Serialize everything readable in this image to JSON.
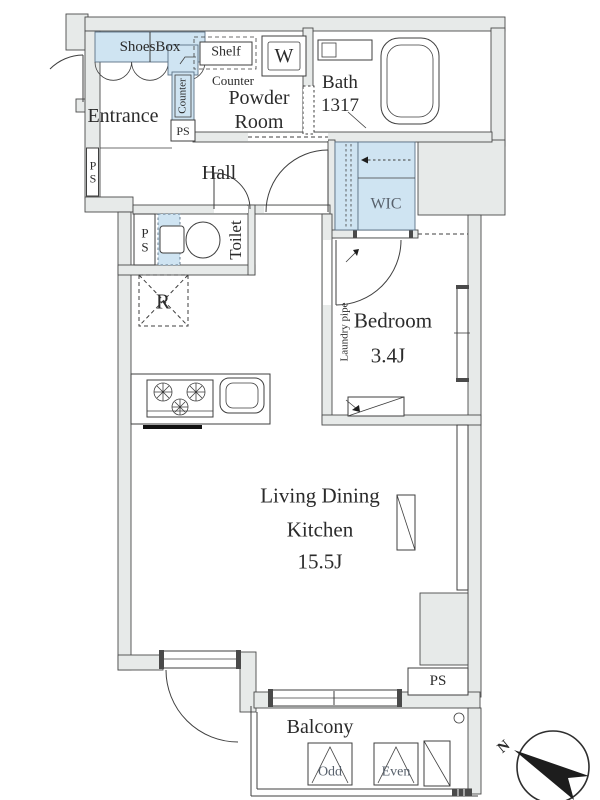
{
  "floorplan": {
    "rooms": {
      "entrance": "Entrance",
      "powder_room": "Powder Room",
      "bath": "Bath 1317",
      "hall": "Hall",
      "toilet": "Toilet",
      "wic": "WIC",
      "bedroom": "Bedroom",
      "bedroom_size": "3.4J",
      "ldk": "Living Dining Kitchen",
      "ldk_size": "15.5J",
      "balcony": "Balcony"
    },
    "fixtures": {
      "shoes_box": "ShoesBox",
      "shelf": "Shelf",
      "counter_vertical": "Counter",
      "counter_horizontal": "Counter",
      "washer": "W",
      "refrigerator": "R",
      "laundry_pipe": "Laundry pipe",
      "partition_odd": "Odd",
      "partition_even": "Even"
    },
    "shafts": {
      "ps_wall": "PS",
      "ps_entrance": "PS",
      "ps_toilet": "PS",
      "ps_living": "PS"
    },
    "compass_north": "N",
    "colors": {
      "wall_fill": "#e7eae9",
      "highlight_fill": "#cfe4f2",
      "line": "#3f3f3f",
      "text": "#2b2b2b"
    }
  }
}
